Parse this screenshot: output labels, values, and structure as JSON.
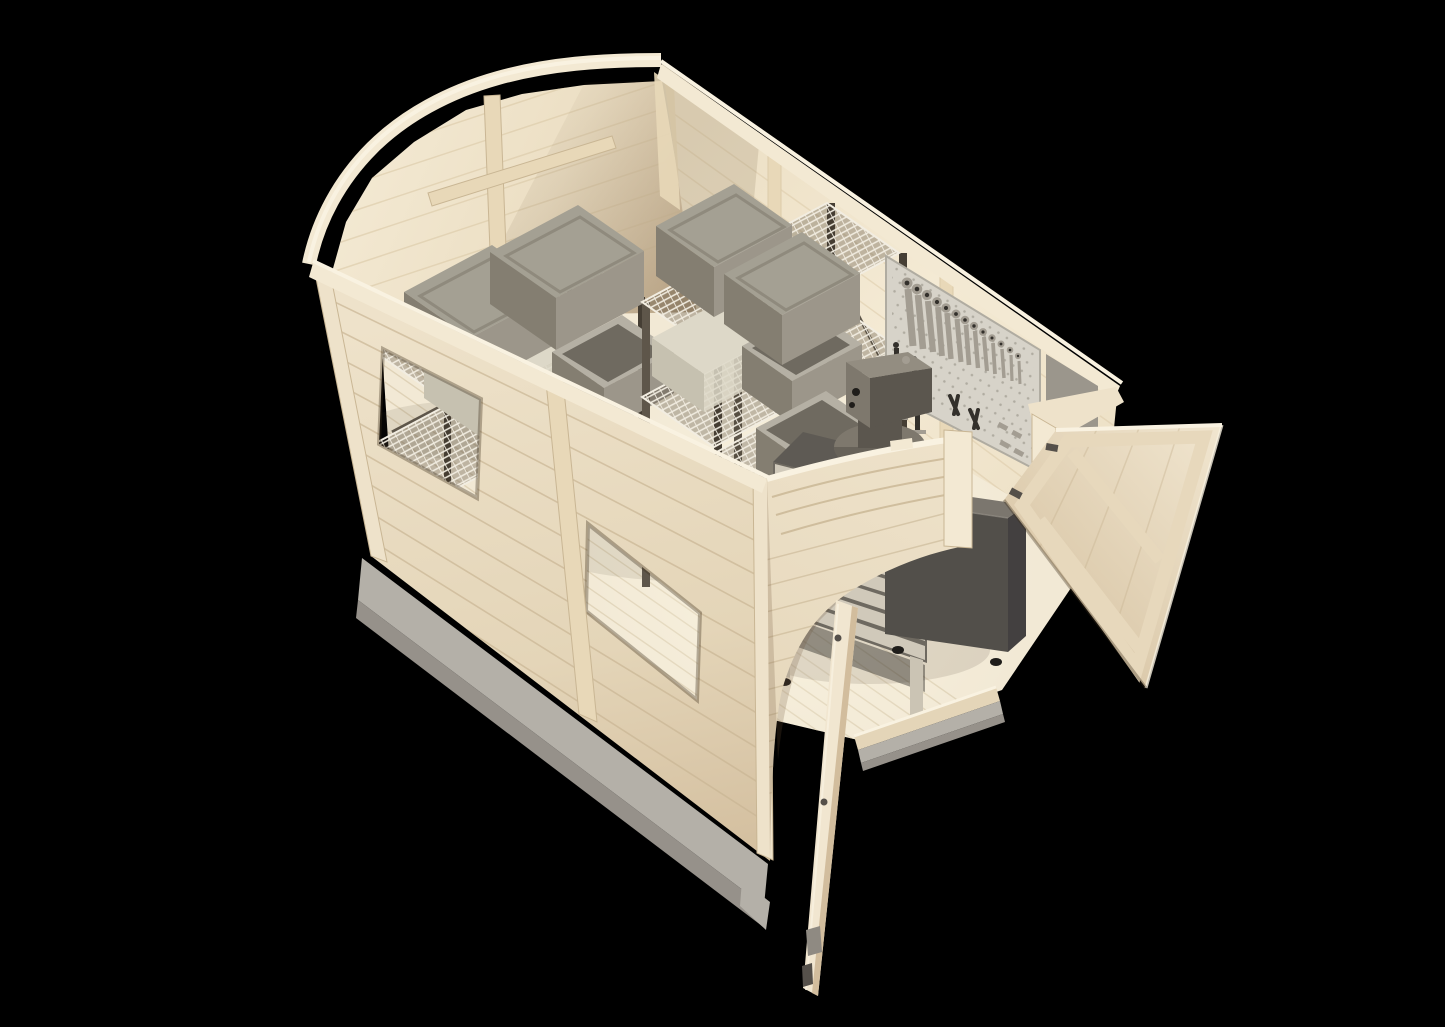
{
  "scene": {
    "description": "3D render, aerial three-quarter view of an open-top wooden barn-style storage shed workshop with interior fittings",
    "view": "isometric top-down cutaway, roof removed",
    "background_color": "#000000"
  },
  "colors": {
    "bg": "#000000",
    "wood_rim": "#f3e9d3",
    "wood_rim_bright": "#f9f2e1",
    "wood_int_light": "#f4ead4",
    "wood_int_mid": "#ecdfc4",
    "wood_int_shadow": "#d9c6a6",
    "wood_ext_light": "#eee2ca",
    "wood_ext_mid": "#e4d5b8",
    "wood_ext_shadow": "#d2bd9d",
    "wood_stud": "#e8d8b8",
    "plank_line": "#c9b694",
    "plank_line_int": "#dccbaa",
    "floor": "#f2e9d5",
    "floor_line": "#dcceb2",
    "concrete": "#b4b0a8",
    "concrete_dark": "#96918a",
    "rack_post": "#5e564a",
    "rack_post_dark": "#453e34",
    "wire": "#f2ede1",
    "bin_lid": "#a4a093",
    "bin_lid_dark": "#8f8a7d",
    "bin_side_light": "#9c968a",
    "bin_side_dark": "#847e71",
    "bin_inner": "#6f6a60",
    "bin_rim": "#b5b0a4",
    "cream_box": "#ddd8c8",
    "cream_box_dark": "#c6c1b0",
    "pegboard": "#d7d3c9",
    "pegboard2": "#9b968c",
    "peg_hole": "#b0aca1",
    "tool_metal": "#a39d92",
    "tool_dark": "#33302b",
    "motor": "#7e786d",
    "motor_dark": "#5b564e",
    "motor_light": "#938d81",
    "bench_top": "#5e5a54",
    "drawer_face": "#d0c9ba",
    "drawer_gap": "#6e6960",
    "leg": "#cbc4b4",
    "cab_top": "#7b766e",
    "cab_front": "#524f4a",
    "cab_side": "#434040",
    "door_face": "#f1e6d0",
    "door_frame": "#e7d8bc",
    "door_edge": "#d8c5a5",
    "black_detail": "#1f1d1a",
    "hinge": "#55504a",
    "latch_metal": "#8f8a82"
  },
  "inventory": {
    "shed": "wooden garden shed with curved barn gables, open-top cutaway",
    "windows_count": 2,
    "doors": {
      "count": 2,
      "state": "both open",
      "style": "Z-braced plank doors"
    },
    "wire_racks_count": 2,
    "bins_lidded_count": 4,
    "bins_open_count": 3,
    "cream_boxes_count": 2,
    "pegboard": {
      "wrenches": 13,
      "clamps": 4,
      "pliers": 2,
      "hooks": 4
    },
    "bench_motor_count": 1,
    "drawer_cabinet_drawers": 9,
    "dark_cabinet_count": 1,
    "foundation": "concrete slab"
  }
}
